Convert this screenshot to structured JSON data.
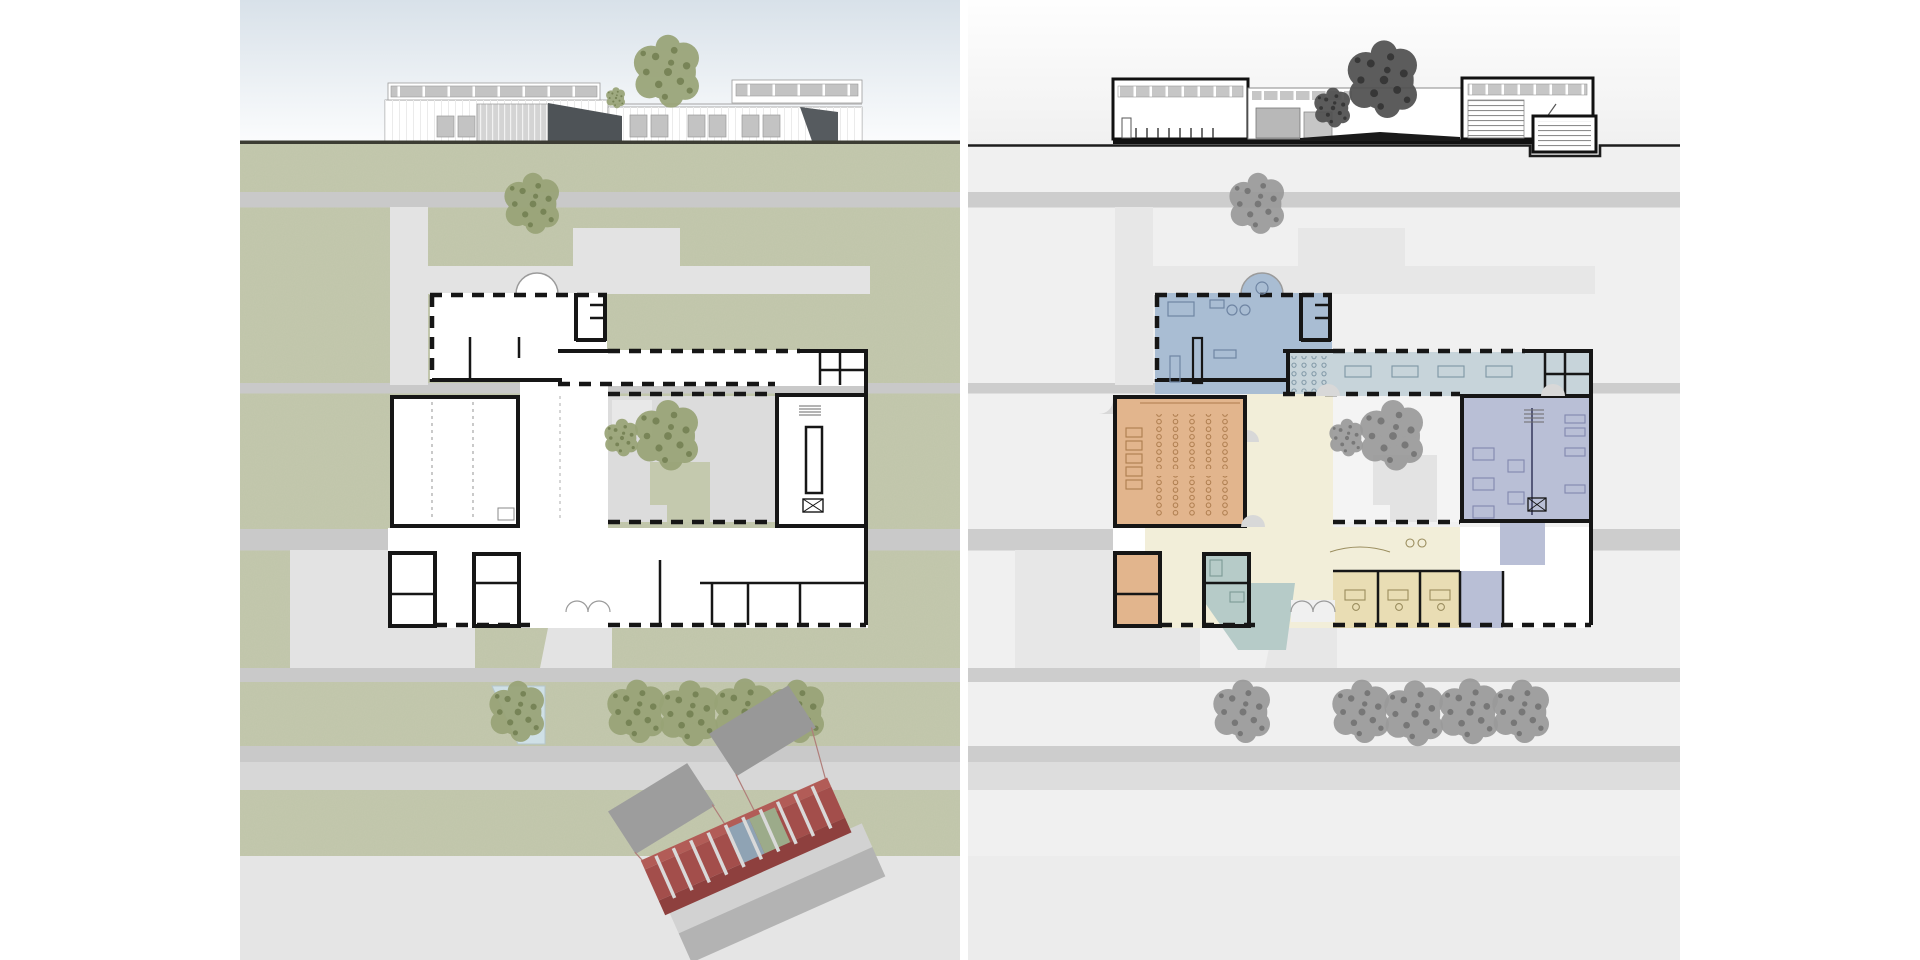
{
  "document": {
    "type": "architectural-presentation",
    "panel_count": 2,
    "panels": [
      {
        "id": "left",
        "content": "site-plan-with-south-elevation",
        "ground": "green-landscape"
      },
      {
        "id": "right",
        "content": "program-floor-plan-with-section",
        "ground": "gray-landscape"
      }
    ]
  },
  "colors": {
    "page_bg": "#ffffff",
    "sky_top": "#d8e1e9",
    "sky_bottom": "#fbfcfd",
    "ground_line_left": "#3c3c33",
    "site_green": "#c4c9ae",
    "grain_tone": "#6d7455",
    "road_gray": "#c9c9c9",
    "path_gray": "#e0e0e0",
    "plaza_gray": "#e3e3e3",
    "lower_band": "#d7d7d7",
    "lower_field": "#e5e5e5",
    "pond_blue": "#cfe0e6",
    "wall_black": "#161616",
    "right_bg": "#f0f0f0",
    "right_top": "#fefefe",
    "right_road": "#cdcdcd",
    "right_path": "#e7e7e7",
    "right_plaza": "#e9e9e9",
    "right_lower_band": "#dddddd",
    "right_lower_field": "#ececec",
    "right_courtyard": "#f4f4f4",
    "right_patch": "#e3e3e3",
    "section_line": "#1c1c1c",
    "facade_white": "#ffffff",
    "glazing_gray": "#c3c3c3",
    "canopy_dark": "#4e5357",
    "elev_outline": "#9b9b9b",
    "tree_green": "#98a376",
    "tree_green_dark": "#6f7c4e",
    "tree_gray": "#9a9a9a",
    "tree_gray_dark": "#6e6e6e",
    "section_tree": "#4f4f4f",
    "section_tree_dark": "#2e2e2e",
    "room_lounge_blue": "#a9bdd3",
    "room_reading_blue": "#c7d4da",
    "room_auditorium_orange": "#e2b58d",
    "room_foyer_cream": "#f2eed9",
    "room_office_yellow": "#e9ddb4",
    "room_library_lavender": "#b9bfd6",
    "room_media_teal": "#b6cbc8",
    "kiosk_red_top": "#b25c57",
    "kiosk_red_floor": "#a34e4b",
    "kiosk_red_front": "#8e403e",
    "kiosk_divider": "#d9d9d9",
    "kiosk_roof": "#9d9d9d",
    "kiosk_base_top": "#d2d2d2",
    "kiosk_base_front": "#b3b3b3",
    "kiosk_panel_blue": "#8fa3b4",
    "kiosk_panel_green": "#9cab8a"
  },
  "scene": {
    "trees": [
      {
        "g": "trees-left",
        "x": 533,
        "y": 204,
        "r": 26,
        "tone": "green"
      },
      {
        "g": "trees-left",
        "x": 622,
        "y": 438,
        "r": 16,
        "tone": "green"
      },
      {
        "g": "trees-left",
        "x": 668,
        "y": 436,
        "r": 30,
        "tone": "green"
      },
      {
        "g": "trees-left",
        "x": 518,
        "y": 712,
        "r": 26,
        "tone": "green"
      },
      {
        "g": "trees-left",
        "x": 637,
        "y": 712,
        "r": 27,
        "tone": "green"
      },
      {
        "g": "trees-left",
        "x": 690,
        "y": 714,
        "r": 28,
        "tone": "green"
      },
      {
        "g": "trees-left",
        "x": 745,
        "y": 712,
        "r": 28,
        "tone": "green"
      },
      {
        "g": "trees-left",
        "x": 797,
        "y": 712,
        "r": 27,
        "tone": "green"
      },
      {
        "g": "trees-left-elev",
        "x": 668,
        "y": 72,
        "r": 31,
        "tone": "green"
      },
      {
        "g": "trees-left-elev",
        "x": 616,
        "y": 98,
        "r": 9,
        "tone": "green"
      },
      {
        "g": "trees-right",
        "x": 1258,
        "y": 204,
        "r": 26,
        "tone": "gray"
      },
      {
        "g": "trees-right",
        "x": 1347,
        "y": 438,
        "r": 16,
        "tone": "gray"
      },
      {
        "g": "trees-right",
        "x": 1393,
        "y": 436,
        "r": 30,
        "tone": "gray"
      },
      {
        "g": "trees-right",
        "x": 1243,
        "y": 712,
        "r": 27,
        "tone": "gray"
      },
      {
        "g": "trees-right",
        "x": 1362,
        "y": 712,
        "r": 27,
        "tone": "gray"
      },
      {
        "g": "trees-right",
        "x": 1415,
        "y": 714,
        "r": 28,
        "tone": "gray"
      },
      {
        "g": "trees-right",
        "x": 1470,
        "y": 712,
        "r": 28,
        "tone": "gray"
      },
      {
        "g": "trees-right",
        "x": 1522,
        "y": 712,
        "r": 27,
        "tone": "gray"
      },
      {
        "g": "trees-right-sec",
        "x": 1384,
        "y": 80,
        "r": 33,
        "tone": "dark"
      },
      {
        "g": "trees-right-sec",
        "x": 1333,
        "y": 108,
        "r": 17,
        "tone": "dark"
      }
    ]
  }
}
